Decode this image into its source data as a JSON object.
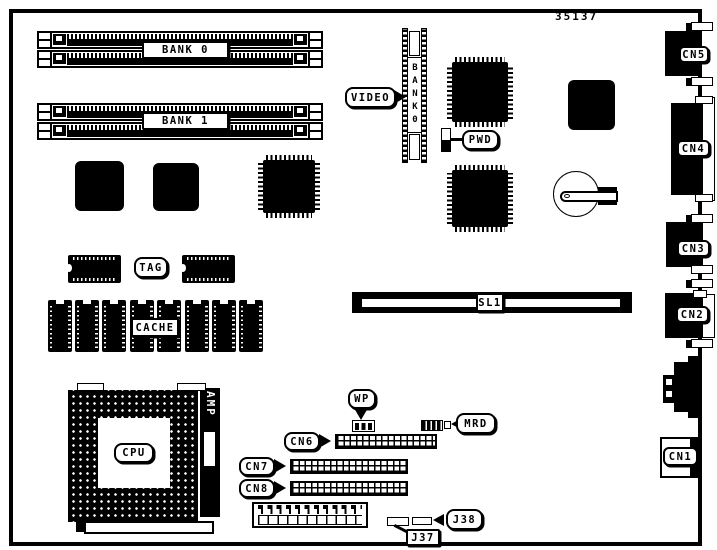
{
  "doc": {
    "drawing_number": "35137"
  },
  "colors": {
    "ink": "#000000",
    "paper": "#ffffff"
  },
  "memory": {
    "banks": [
      {
        "label": "BANK 0"
      },
      {
        "label": "BANK 1"
      }
    ]
  },
  "video": {
    "callout": "VIDEO",
    "connector_label": "BANK0"
  },
  "jumpers": {
    "pwd": "PWD",
    "wp": "WP",
    "mrd": "MRD"
  },
  "cache": {
    "tag": "TAG",
    "cache": "CACHE"
  },
  "cpu": {
    "label": "CPU",
    "socket_brand": "AMP"
  },
  "slot": {
    "label": "SL1"
  },
  "rear_connectors": [
    {
      "label": "CN5"
    },
    {
      "label": "CN4"
    },
    {
      "label": "CN3"
    },
    {
      "label": "CN2"
    },
    {
      "label": "CN1"
    }
  ],
  "headers": [
    {
      "label": "CN6"
    },
    {
      "label": "CN7"
    },
    {
      "label": "CN8"
    }
  ],
  "solder_jumpers": [
    {
      "label": "J37"
    },
    {
      "label": "J38"
    }
  ]
}
